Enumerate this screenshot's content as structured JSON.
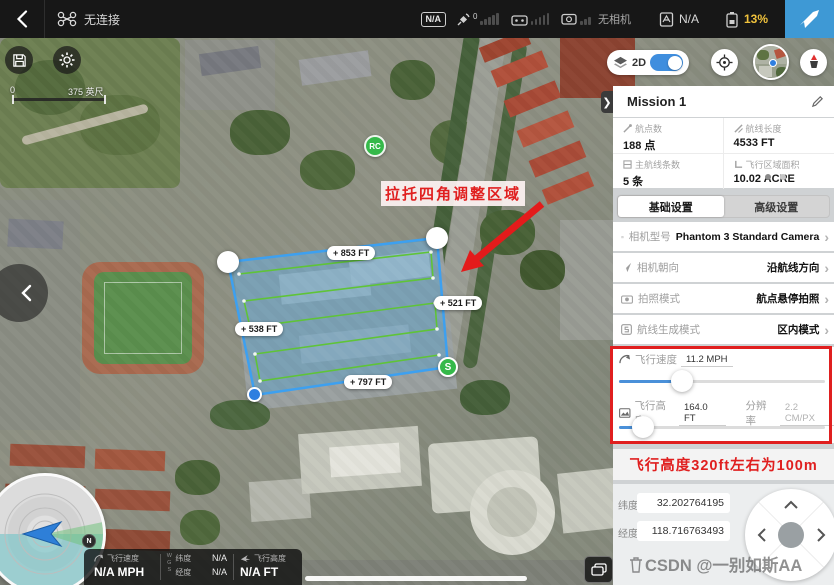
{
  "topbar": {
    "connection_status": "无连接",
    "signal_badge": "N/A",
    "gps_count": "0",
    "camera_status": "无相机",
    "flight_mode": "N/A",
    "battery_percent": "13%"
  },
  "map_controls": {
    "mode_label": "2D",
    "scale_start": "0",
    "scale_end": "375 英尺"
  },
  "map_overlay": {
    "annotation": "拉托四角调整区域",
    "edge_labels": [
      "+ 853 FT",
      "+ 521 FT",
      "+ 538 FT",
      "+ 797 FT"
    ],
    "start_marker": "S",
    "rc_marker": "RC"
  },
  "panel": {
    "title": "Mission 1",
    "stats": [
      {
        "label": "航点数",
        "value": "188 点"
      },
      {
        "label": "航线长度",
        "value": "4533 FT"
      },
      {
        "label": "主航线条数",
        "value": "5 条"
      },
      {
        "label": "飞行区域面积",
        "value": "10.02 ACRE"
      }
    ],
    "tabs": [
      {
        "label": "基础设置"
      },
      {
        "label": "高级设置"
      }
    ],
    "settings": [
      {
        "label": "相机型号",
        "value": "Phantom 3 Standard Camera"
      },
      {
        "label": "相机朝向",
        "value": "沿航线方向"
      },
      {
        "label": "拍照模式",
        "value": "航点悬停拍照"
      },
      {
        "label": "航线生成模式",
        "value": "区内模式"
      }
    ],
    "speed": {
      "label": "飞行速度",
      "value": "11.2 MPH"
    },
    "altitude": {
      "label": "飞行高度",
      "value": "164.0 FT",
      "res_label": "分辨率",
      "res_value": "2.2 CM/PX"
    },
    "altitude_note": "飞行高度320ft左右为100m",
    "coordinates": {
      "lat_label": "纬度",
      "lat_value": "32.202764195",
      "lng_label": "经度",
      "lng_value": "118.716763493"
    }
  },
  "telemetry": {
    "speed_label": "飞行速度",
    "speed_value": "N/A MPH",
    "datum": "WGS",
    "lat_label": "纬度",
    "lat_value": "N/A",
    "lng_label": "经度",
    "lng_value": "N/A",
    "alt_label": "飞行高度",
    "alt_value": "N/A FT",
    "compass_north": "N"
  },
  "watermark": "CSDN @一别如斯AA",
  "colors": {
    "accent_blue": "#3E99D5",
    "battery_warning": "#F0C23C",
    "annotation_red": "#E01F1F",
    "route_green": "#5FC437",
    "polygon_blue": "#3DA0F0"
  }
}
